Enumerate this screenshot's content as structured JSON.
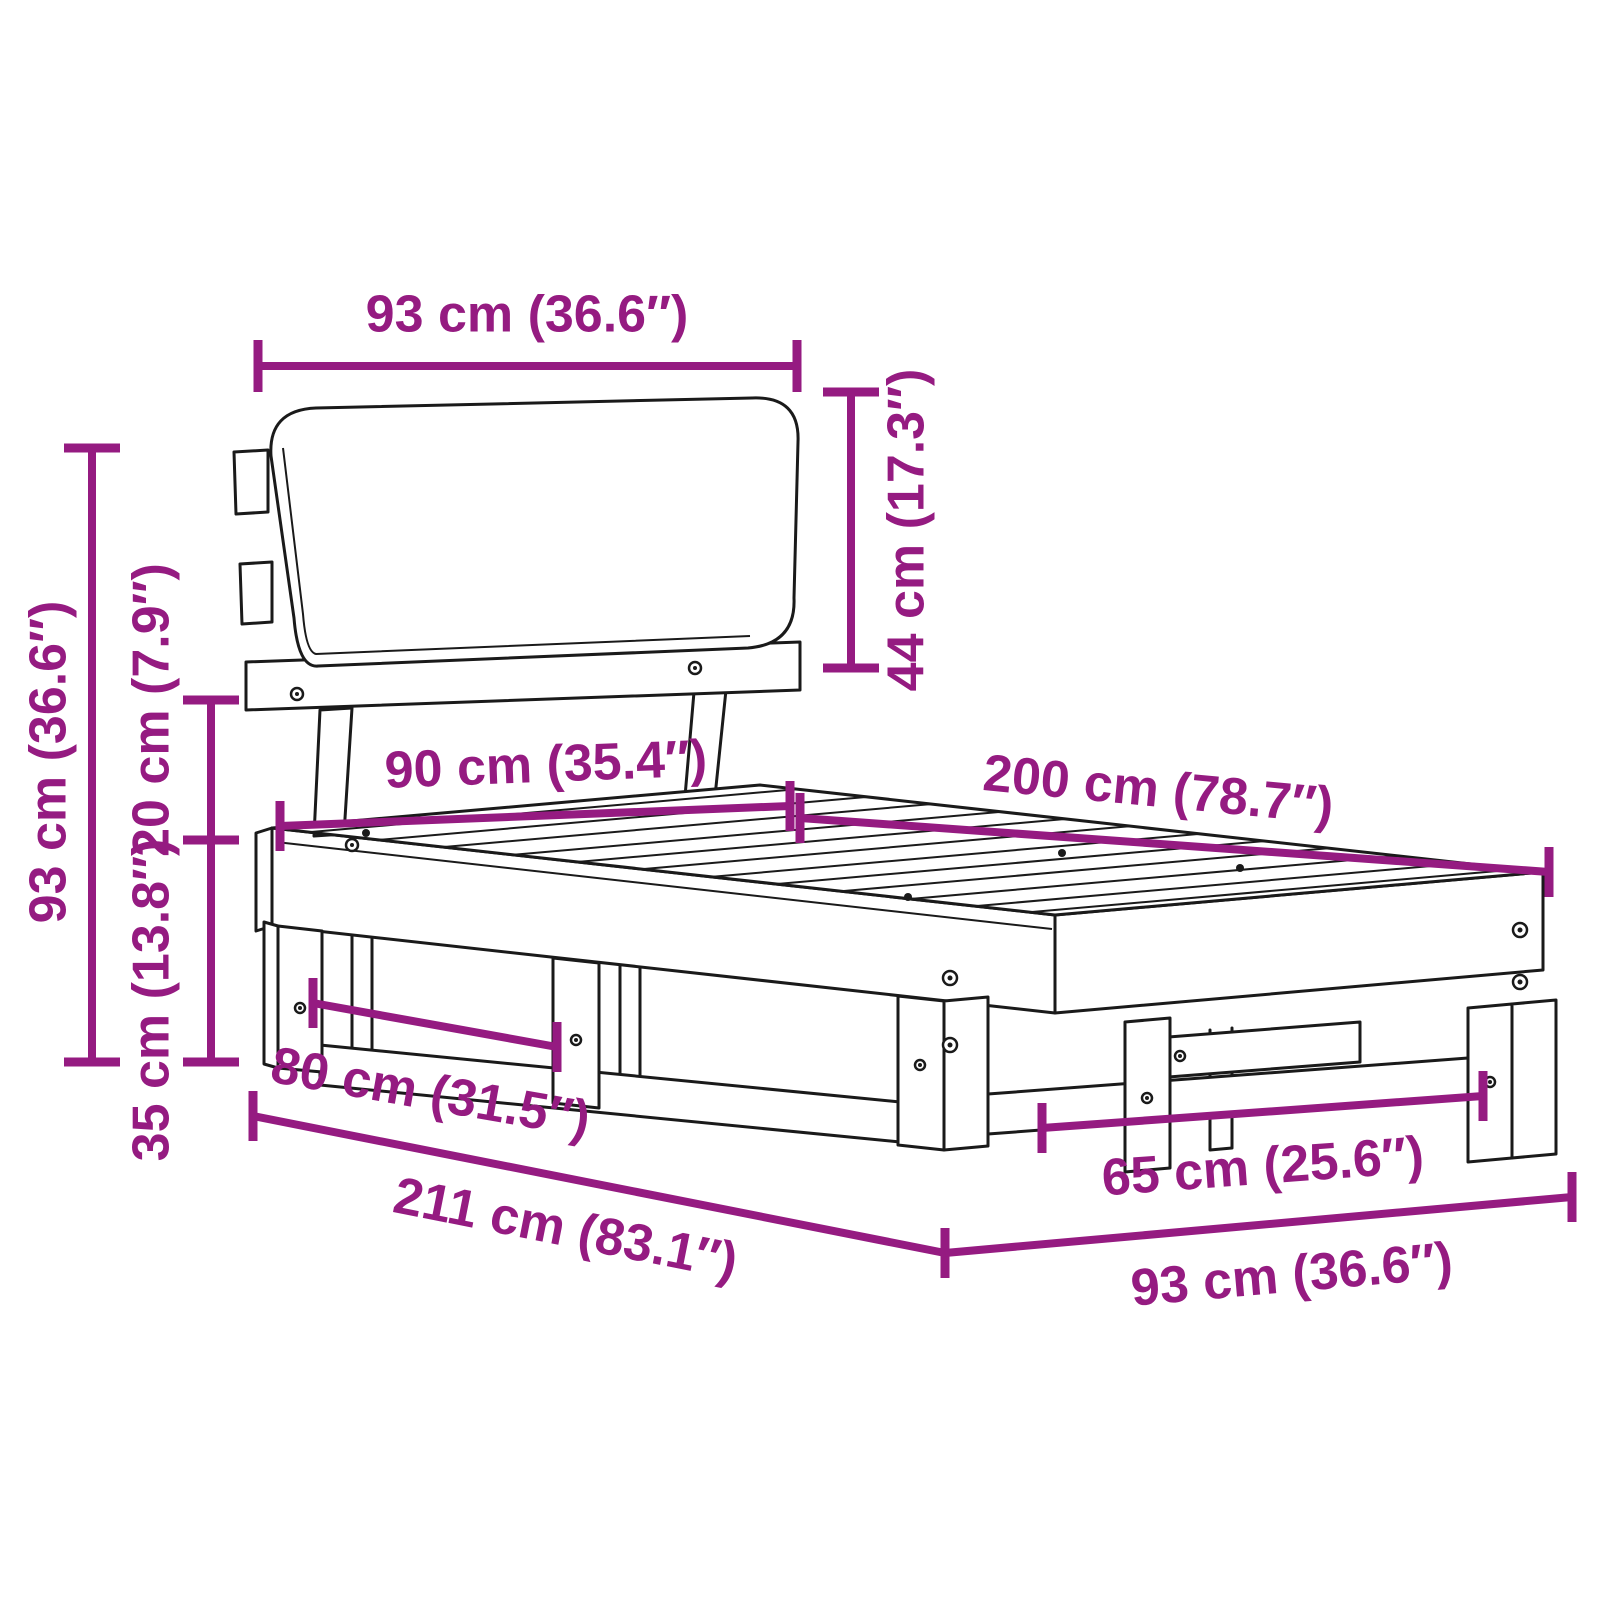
{
  "diagram": {
    "type": "furniture-dimension-diagram",
    "subject": "single bed frame with slatted base and cushioned headboard",
    "unit_note": "metric (cm) with imperial (inches) in parentheses",
    "colors": {
      "dimension": "#951B81",
      "outline": "#1a1a1a",
      "background": "#ffffff"
    },
    "dimensions": {
      "headboard_width": {
        "label": "93 cm (36.6″)",
        "cm": 93,
        "inches": 36.6,
        "orientation": "horizontal-top"
      },
      "headboard_height": {
        "label": "44 cm (17.3″)",
        "cm": 44,
        "inches": 17.3,
        "orientation": "vertical-right-of-headboard"
      },
      "total_height": {
        "label": "93 cm (36.6″)",
        "cm": 93,
        "inches": 36.6,
        "orientation": "vertical-left-outer"
      },
      "headboard_gap": {
        "label": "20 cm (7.9″)",
        "cm": 20,
        "inches": 7.9,
        "orientation": "vertical-left-inner-upper"
      },
      "frame_height": {
        "label": "35 cm (13.8″)",
        "cm": 35,
        "inches": 13.8,
        "orientation": "vertical-left-inner-lower"
      },
      "bed_width": {
        "label": "90 cm (35.4″)",
        "cm": 90,
        "inches": 35.4,
        "orientation": "across-head-end"
      },
      "bed_length": {
        "label": "200 cm (78.7″)",
        "cm": 200,
        "inches": 78.7,
        "orientation": "along-side-top"
      },
      "front_leg_spacing": {
        "label": "80 cm (31.5″)",
        "cm": 80,
        "inches": 31.5,
        "orientation": "between-front-legs"
      },
      "total_length": {
        "label": "211 cm (83.1″)",
        "cm": 211,
        "inches": 83.1,
        "orientation": "diagonal-bottom-left"
      },
      "foot_leg_spacing": {
        "label": "65 cm (25.6″)",
        "cm": 65,
        "inches": 25.6,
        "orientation": "between-foot-legs"
      },
      "foot_width": {
        "label": "93 cm (36.6″)",
        "cm": 93,
        "inches": 36.6,
        "orientation": "diagonal-bottom-right"
      }
    }
  }
}
